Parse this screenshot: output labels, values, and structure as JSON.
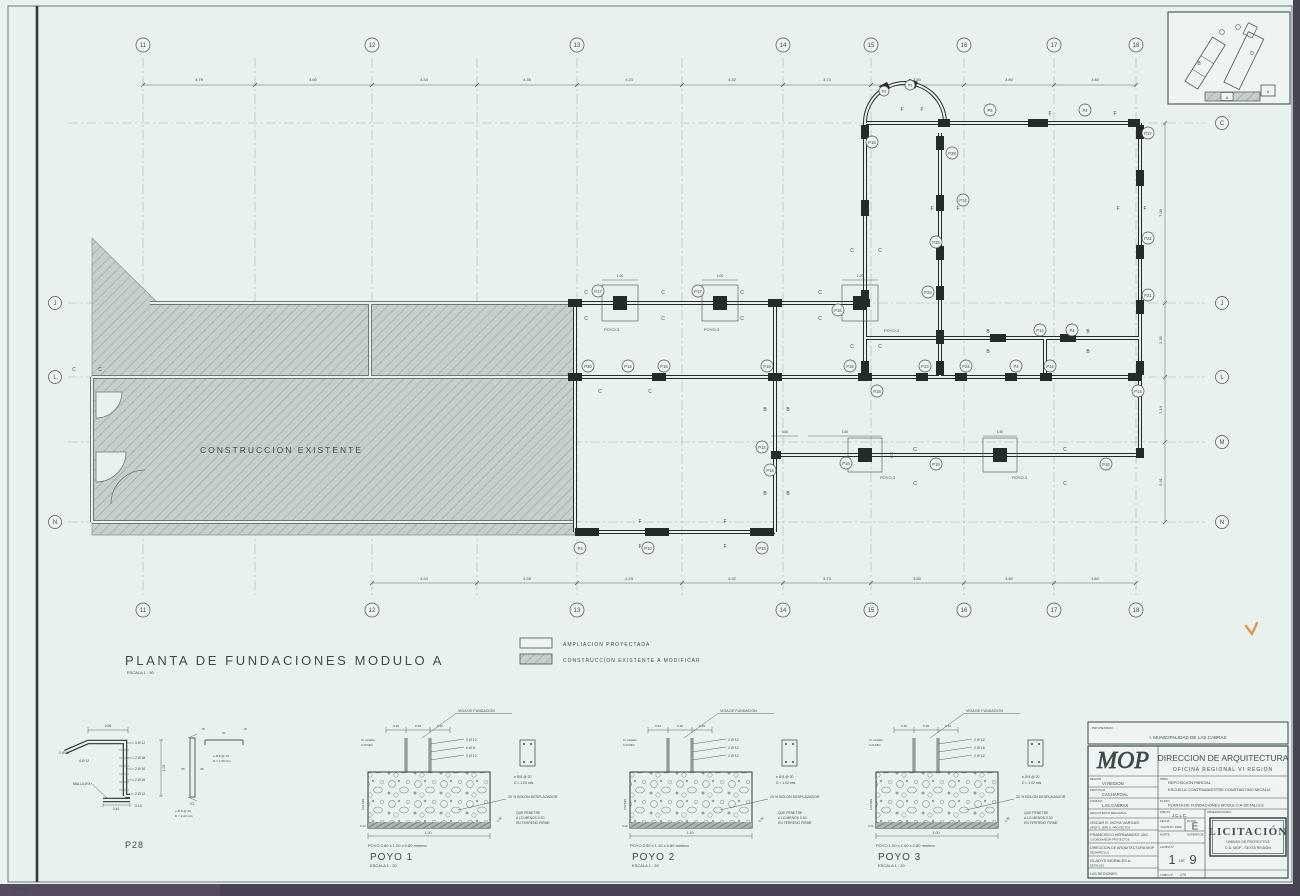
{
  "sheet": {
    "corner_code": "P2443"
  },
  "keyplan": {
    "module_b": "B",
    "module_d": "D",
    "module_a_strip": "A",
    "module_a_box": "A"
  },
  "plan": {
    "title": "PLANTA DE FUNDACIONES MODULO A",
    "scale": "ESCALA 1 : 50",
    "existing_label": "CONSTRUCCION EXISTENTE",
    "poyo3_label": "POYO-3",
    "letters": {
      "C": "C",
      "F": "F",
      "B": "B"
    },
    "axes": {
      "top": [
        "11",
        "12",
        "13",
        "14",
        "15",
        "16",
        "17",
        "18"
      ],
      "bottom": [
        "11",
        "12",
        "13",
        "14",
        "15",
        "16",
        "17",
        "18"
      ],
      "left": [
        "J",
        "L",
        "N"
      ],
      "right": [
        "C",
        "J",
        "L",
        "M",
        "N"
      ]
    },
    "dims_top": [
      "4.79",
      "4.60",
      "4.34",
      "4.35",
      "4.23",
      "4.32",
      "3.73",
      "3.80",
      "3.80",
      "3.80"
    ],
    "dims_bottom": [
      "4.34",
      "4.35",
      "4.23",
      "4.32",
      "3.73",
      "3.80",
      "3.80",
      "3.80"
    ],
    "dims_right": [
      "7.08",
      "2.35",
      "2.14",
      "3.41"
    ],
    "small_dims": [
      "1.00",
      "1.00",
      "1.00",
      "0.60",
      "1.60",
      "1.50",
      "1.00"
    ],
    "footings": [
      "P17",
      "P17",
      "P16",
      "P12",
      "P15",
      "P19",
      "P18",
      "P23",
      "P24",
      "P4",
      "P14",
      "P14",
      "P15",
      "P28",
      "P5",
      "P4",
      "P27",
      "P14",
      "P25",
      "P22",
      "P24",
      "P14",
      "P4",
      "P21",
      "P3",
      "P10",
      "P19",
      "P14",
      "P16",
      "P18",
      "P19",
      "P16",
      "P6",
      "P5",
      "P20",
      "P19"
    ]
  },
  "legend": {
    "items": [
      {
        "label": "AMPLIACION PROYECTADA"
      },
      {
        "label": "CONSTRUCCION EXISTENTE A MODIFICAR"
      }
    ]
  },
  "details": {
    "p28": {
      "title": "P28",
      "dim_top": "0.66",
      "dim_height": "1.05",
      "dim_base": "0.40",
      "dim_offset": "0.15",
      "callout_left_1": "2 Ø 12",
      "callout_left_2": "4 Ø 12",
      "callout_left_3": "MALLA Ø 8",
      "callouts_right": [
        "3 Ø 12",
        "2 Ø 16",
        "2 Ø 16",
        "2 Ø 16",
        "2 Ø 12"
      ],
      "bar_left": "95",
      "bar_right": "95",
      "bar_tag": "V2",
      "bar_len": "61",
      "hook_l": "18",
      "hook_r": "18",
      "note1a": "e Ø 8 @ 13",
      "note1b": "D = 1.50 mts",
      "note2a": "e Ø 8 @ 10",
      "note2b": "D = 2.23 mts"
    },
    "poyos": [
      {
        "title": "POYO 1",
        "scale": "ESCALA 1 : 20",
        "viga": "VIGA DE FUNDACION",
        "dim_a": "0.40",
        "dim_b": "0.20",
        "dim_c": "0.40",
        "rebar_top": "2 Ø 12",
        "rebar_mid": "e Ø 8",
        "rebar_bot": "2 Ø 12",
        "stirrup": "e Ø 8 @ 20",
        "depth": "D = 1.03 mts",
        "bolon": "20 % BOLON DESPLAZADOR",
        "pen1": "QUE PENETRE",
        "pen2": "A LO MENOS 0.30",
        "pen3": "EN TERRENO FIRME",
        "slant": "0.30",
        "h1": "h= variable",
        "h2": "0.20 MIN.",
        "side": "0.80 MIN.",
        "seal": "0.10",
        "dim_bottom": "1.20",
        "caption": "POYO 0.80 x 1.20 x 0.80 mínimo"
      },
      {
        "title": "POYO 2",
        "scale": "ESCALA 1 : 20",
        "viga": "VIGA DE FUNDACION",
        "dim_a": "0.43",
        "dim_b": "0.20",
        "dim_c": "0.49",
        "rebar_top": "2 Ø 12",
        "rebar_mid": "2 Ø 12",
        "rebar_bot": "2 Ø 12",
        "stirrup": "e Ø 8 @ 20",
        "depth": "D = 1.02 mts",
        "bolon": "20 % BOLON DESPLAZADOR",
        "pen1": "QUE PENETRE",
        "pen2": "A LO MENOS 0.30",
        "pen3": "EN TERRENO FIRME",
        "slant": "0.30",
        "h1": "h= variable",
        "h2": "0.20 MIN.",
        "side": "0.80 MIN.",
        "seal": "0.10",
        "dim_bottom": "1.10",
        "caption": "POYO 0.90 x 1.10 x 0.80 mínimo"
      },
      {
        "title": "POYO 3",
        "scale": "ESCALA 1 : 20",
        "viga": "VIGA DE FUNDACION",
        "dim_a": "0.40",
        "dim_b": "0.20",
        "dim_c": "0.40",
        "rebar_top": "2 Ø 12",
        "rebar_mid": "2 Ø 16",
        "rebar_bot": "2 Ø 12",
        "stirrup": "e Ø 8 @ 20",
        "depth": "D = 1.02 mts",
        "bolon": "20 % BOLON DESPLAZADOR",
        "pen1": "QUE PENETRE",
        "pen2": "A LO MENOS 0.30",
        "pen3": "EN TERRENO FIRME",
        "slant": "0.30",
        "h1": "h= variable",
        "h2": "0.20 MIN.",
        "side": "0.80 MIN.",
        "seal": "0.10",
        "dim_bottom": "1.00",
        "caption": "POYO 1.00 x 1.00 x 0.80 mínimo"
      }
    ]
  },
  "titleblock": {
    "owner_label": "PROPIETARIO :",
    "owner": "I. MUNICIPALIDAD DE LAS CABRAS",
    "logo": "MOP",
    "dept": "DIRECCION DE ARQUITECTURA",
    "office": "OFICINA REGIONAL VI REGION",
    "region_label": "REGION",
    "region": "VI REGION",
    "provincia_label": "PROVINCIA",
    "provincia": "CACHAPOAL",
    "comuna_label": "COMUNA",
    "comuna": "LAS CABRAS",
    "obra_label": "OBRA",
    "obra1": "REPOSICION PARCIAL",
    "obra2": "ESCUELA CONTRAMAESTRE CONSTANTINO MICALVI",
    "plano_label": "PLANO",
    "plano": "PLANTA DE FUNDACIONES MODULO A-DETALLES",
    "arquitecto_label": "ARQUITECTO REGIONAL",
    "arquitecto": "OSCAR E. MOYA VARGAS",
    "arquitecto_sub": "ARQTO. JEFE U. PROYECTOS",
    "dibujo_label": "DIBUJO",
    "dibujo": "J.C.L.C.",
    "obs_label": "OBSERVACIONES",
    "revisor": "FRANCISCO HERNANDEZ JAC.",
    "revisor_sub": "COORDINADOR PROYECTOS",
    "direccion": "DIRECCION DE ARQUITECTURA MOP",
    "direccion_sub": "DESARROLLO",
    "aprobo": "GLADYS MORALES A.",
    "aprobo_sub": "DETALLES",
    "pie": "LAS REGIONES",
    "fecha_label": "FECHA",
    "fecha": "AGOSTO 1992",
    "clave_label": "CLAVE",
    "clave": "E",
    "norte_label": "NORTE",
    "superficie_label": "SUPERFICIE",
    "lamina_label": "LAMINA Nº",
    "lamina_num": "1",
    "lamina_de": "DE",
    "lamina_total": "9",
    "tubo_label": "TUBO Nº",
    "tubo": "275",
    "stamp1": "LICITACIÓN",
    "stamp2": "UNIDAD DE PROYECTOS",
    "stamp3": "D.A. MOP - SEXTA REGIÓN"
  }
}
